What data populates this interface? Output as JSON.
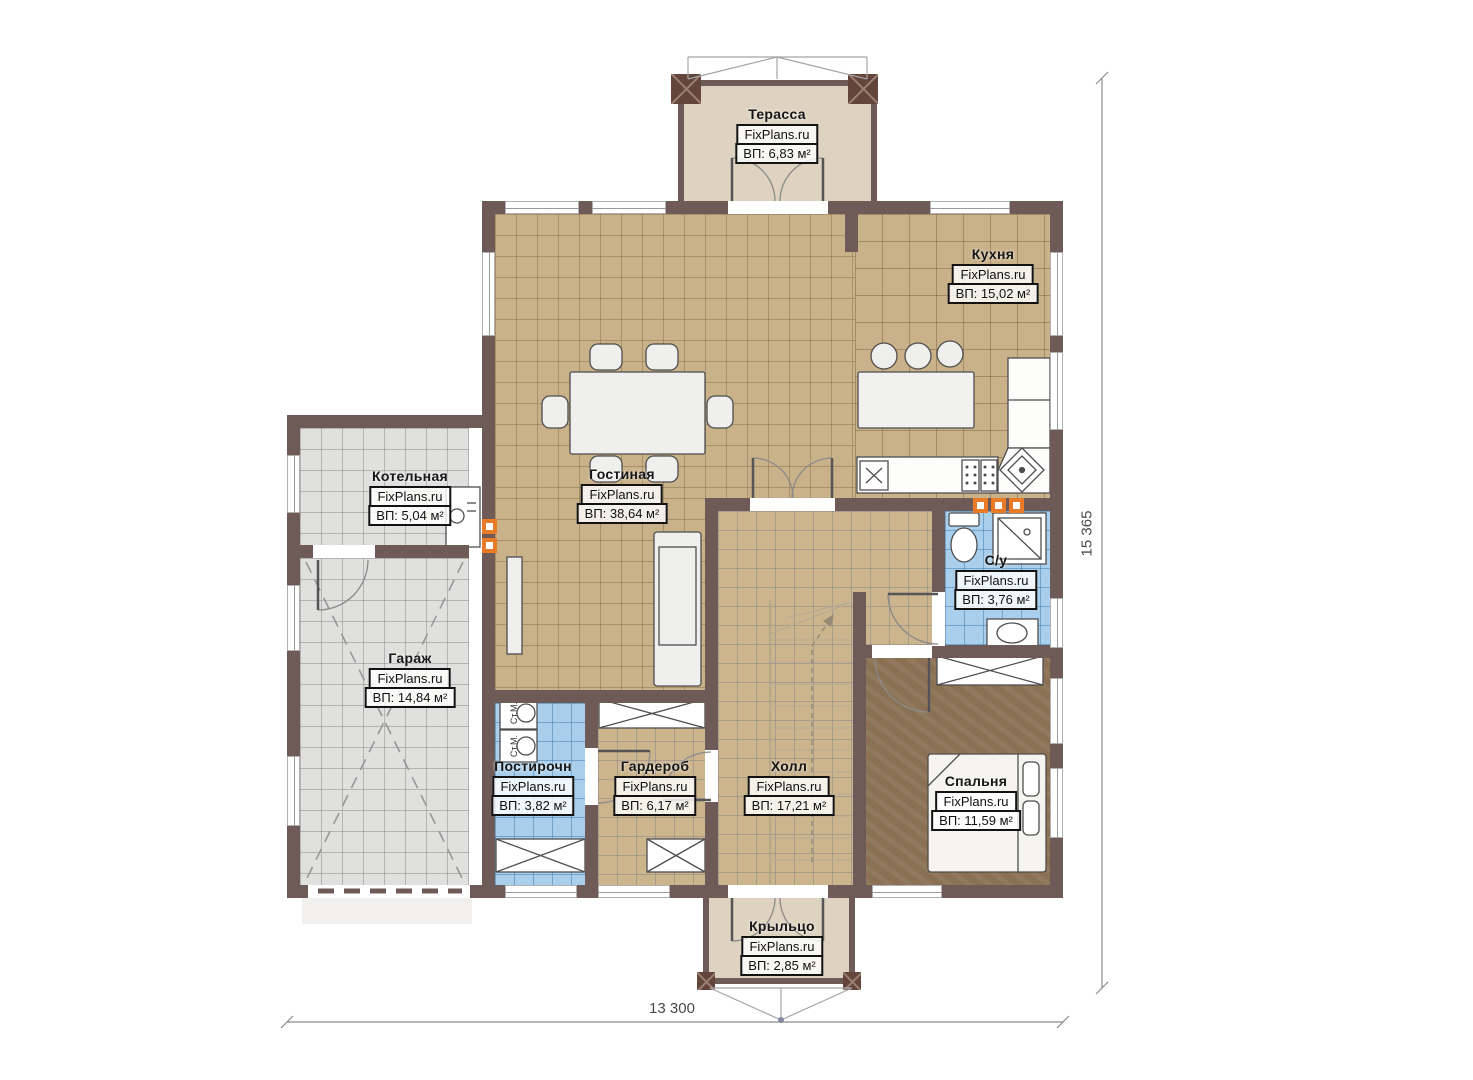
{
  "watermark": "FixPlans.ru",
  "rooms": [
    {
      "name": "Терасса",
      "area": "ВП: 6,83 м²"
    },
    {
      "name": "Кухня",
      "area": "ВП: 15,02 м²"
    },
    {
      "name": "Гостиная",
      "area": "ВП: 38,64 м²"
    },
    {
      "name": "Котельная",
      "area": "ВП: 5,04 м²"
    },
    {
      "name": "Гараж",
      "area": "ВП: 14,84 м²"
    },
    {
      "name": "С/у",
      "area": "ВП: 3,76 м²"
    },
    {
      "name": "Постирочн",
      "area": "ВП: 3,82 м²"
    },
    {
      "name": "Гардероб",
      "area": "ВП: 6,17 м²"
    },
    {
      "name": "Холл",
      "area": "ВП: 17,21 м²"
    },
    {
      "name": "Спальня",
      "area": "ВП: 11,59 м²"
    },
    {
      "name": "Крыльцо",
      "area": "ВП: 2,85 м²"
    }
  ],
  "dimensions": {
    "bottom": "13 300",
    "right": "15 365"
  },
  "appliances": {
    "washing_machine": "Ст.М."
  },
  "colors": {
    "wall": "#6e5b58",
    "floor_tan": "#c9b189",
    "floor_gray": "#e0e0df",
    "floor_blue": "#a9cfec",
    "floor_brown": "#8a7154",
    "floor_beige": "#ded3c0",
    "radiator": "#e87a28"
  }
}
